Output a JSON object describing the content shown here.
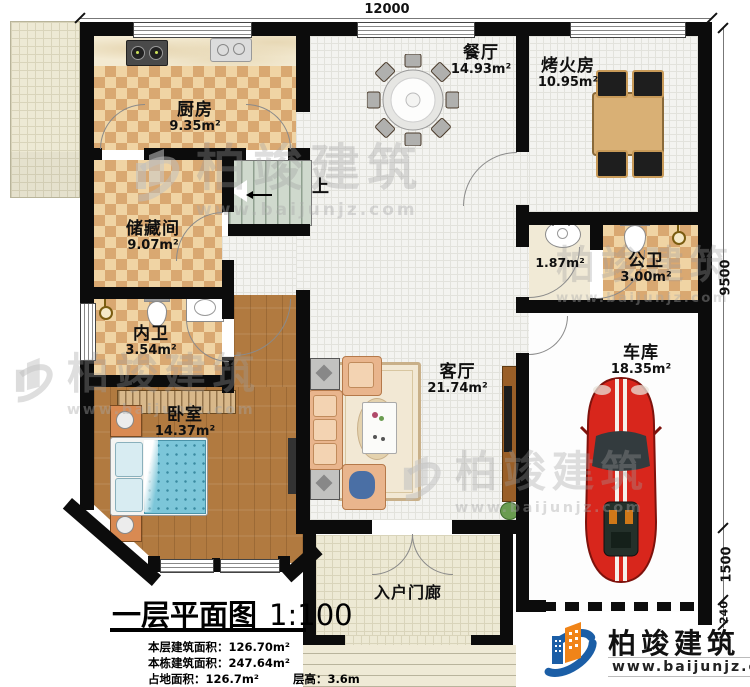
{
  "dimensions": {
    "top_width": "12000",
    "right_height_main": "9500",
    "right_height_porch": "1500",
    "right_wall_thickness": "240"
  },
  "rooms": {
    "kitchen": {
      "name": "厨房",
      "area": "9.35m²"
    },
    "dining": {
      "name": "餐厅",
      "area": "14.93m²"
    },
    "fire_room": {
      "name": "烤火房",
      "area": "10.95m²"
    },
    "storage": {
      "name": "储藏间",
      "area": "9.07m²"
    },
    "inner_bath": {
      "name": "内卫",
      "area": "3.54m²"
    },
    "wash_area": {
      "area": "1.87m²"
    },
    "public_bath": {
      "name": "公卫",
      "area": "3.00m²"
    },
    "bedroom": {
      "name": "卧室",
      "area": "14.37m²"
    },
    "living_room": {
      "name": "客厅",
      "area": "21.74m²"
    },
    "garage": {
      "name": "车库",
      "area": "18.35m²"
    },
    "porch": {
      "name": "入户门廊"
    }
  },
  "stairs": {
    "label": "上"
  },
  "title_block": {
    "title": "一层平面图",
    "scale": "1:100",
    "stats": {
      "s1_label": "本层建筑面积：",
      "s1_value": "126.70m²",
      "s2_label": "本栋建筑面积：",
      "s2_value": "247.64m²",
      "s3a_label": "占地面积：",
      "s3a_value": "126.7m²",
      "s3b_label": "层高：",
      "s3b_value": "3.6m"
    }
  },
  "logo": {
    "brand": "柏竣建筑",
    "site": "www.baijunjz.com"
  },
  "watermark": {
    "brand": "柏竣建筑",
    "site": "www.baijunjz.com"
  },
  "colors": {
    "wall": "#0c0c0c",
    "checker_light": "#f0d4a4",
    "checker_dark": "#d9a871",
    "wood_floor": "#b17a40",
    "stair_floor": "#cfd9cd",
    "car_red": "#d42a1e",
    "blanket_blue": "#7cc6d9",
    "logo_blue": "#1b5ea6",
    "logo_orange": "#f08418"
  }
}
